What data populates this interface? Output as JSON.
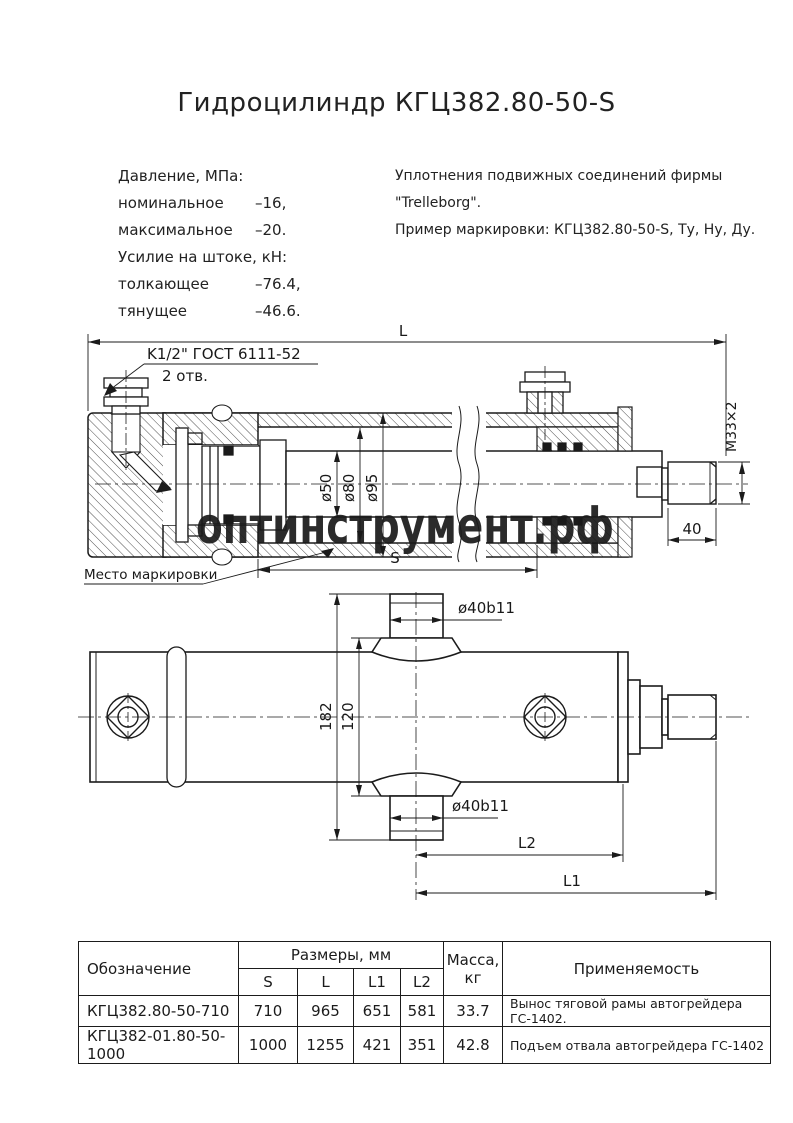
{
  "title": "Гидроцилиндр КГЦ382.80-50-S",
  "specs": {
    "pressure_header": "Давление, МПа:",
    "pressure_rows": [
      {
        "label": "номинальное",
        "value": "–16,"
      },
      {
        "label": "максимальное",
        "value": "–20."
      }
    ],
    "force_header": "Усилие на штоке, кН:",
    "force_rows": [
      {
        "label": "толкающее",
        "value": "–76.4,"
      },
      {
        "label": "тянущее",
        "value": "–46.6."
      }
    ],
    "seals_line1": "Уплотнения подвижных соединений фирмы",
    "seals_line2": "\"Trelleborg\".",
    "marking_example": "Пример маркировки: КГЦ382.80-50-S, Ту, Ну, Ду."
  },
  "drawing1": {
    "length": "L",
    "port_spec": "K1/2\" ГОСТ 6111-52",
    "port_holes": "2 отв.",
    "d50": "ø50",
    "d80": "ø80",
    "d95": "ø95",
    "thread": "М33×2",
    "thread_len": "40",
    "stroke": "S",
    "marking": "Место маркировки"
  },
  "drawing2": {
    "pin_dia": "ø40b11",
    "h182": "182",
    "h120": "120",
    "l2": "L2",
    "l1": "L1"
  },
  "watermark": "оптинструмент.рф",
  "table": {
    "headers": {
      "designation": "Обозначение",
      "dimensions": "Размеры, мм",
      "dim_cols": [
        "S",
        "L",
        "L1",
        "L2"
      ],
      "mass_line1": "Масса,",
      "mass_line2": "кг",
      "application": "Применяемость"
    },
    "rows": [
      {
        "designation": "КГЦ382.80-50-710",
        "s": "710",
        "l": "965",
        "l1": "651",
        "l2": "581",
        "mass": "33.7",
        "application": "Вынос тяговой рамы автогрейдера ГС-1402."
      },
      {
        "designation": "КГЦ382-01.80-50-1000",
        "s": "1000",
        "l": "1255",
        "l1": "421",
        "l2": "351",
        "mass": "42.8",
        "application": "Подъем отвала автогрейдера ГС-1402"
      }
    ]
  },
  "colors": {
    "line": "#1b1b1b",
    "watermark": "#c8cfe9"
  }
}
